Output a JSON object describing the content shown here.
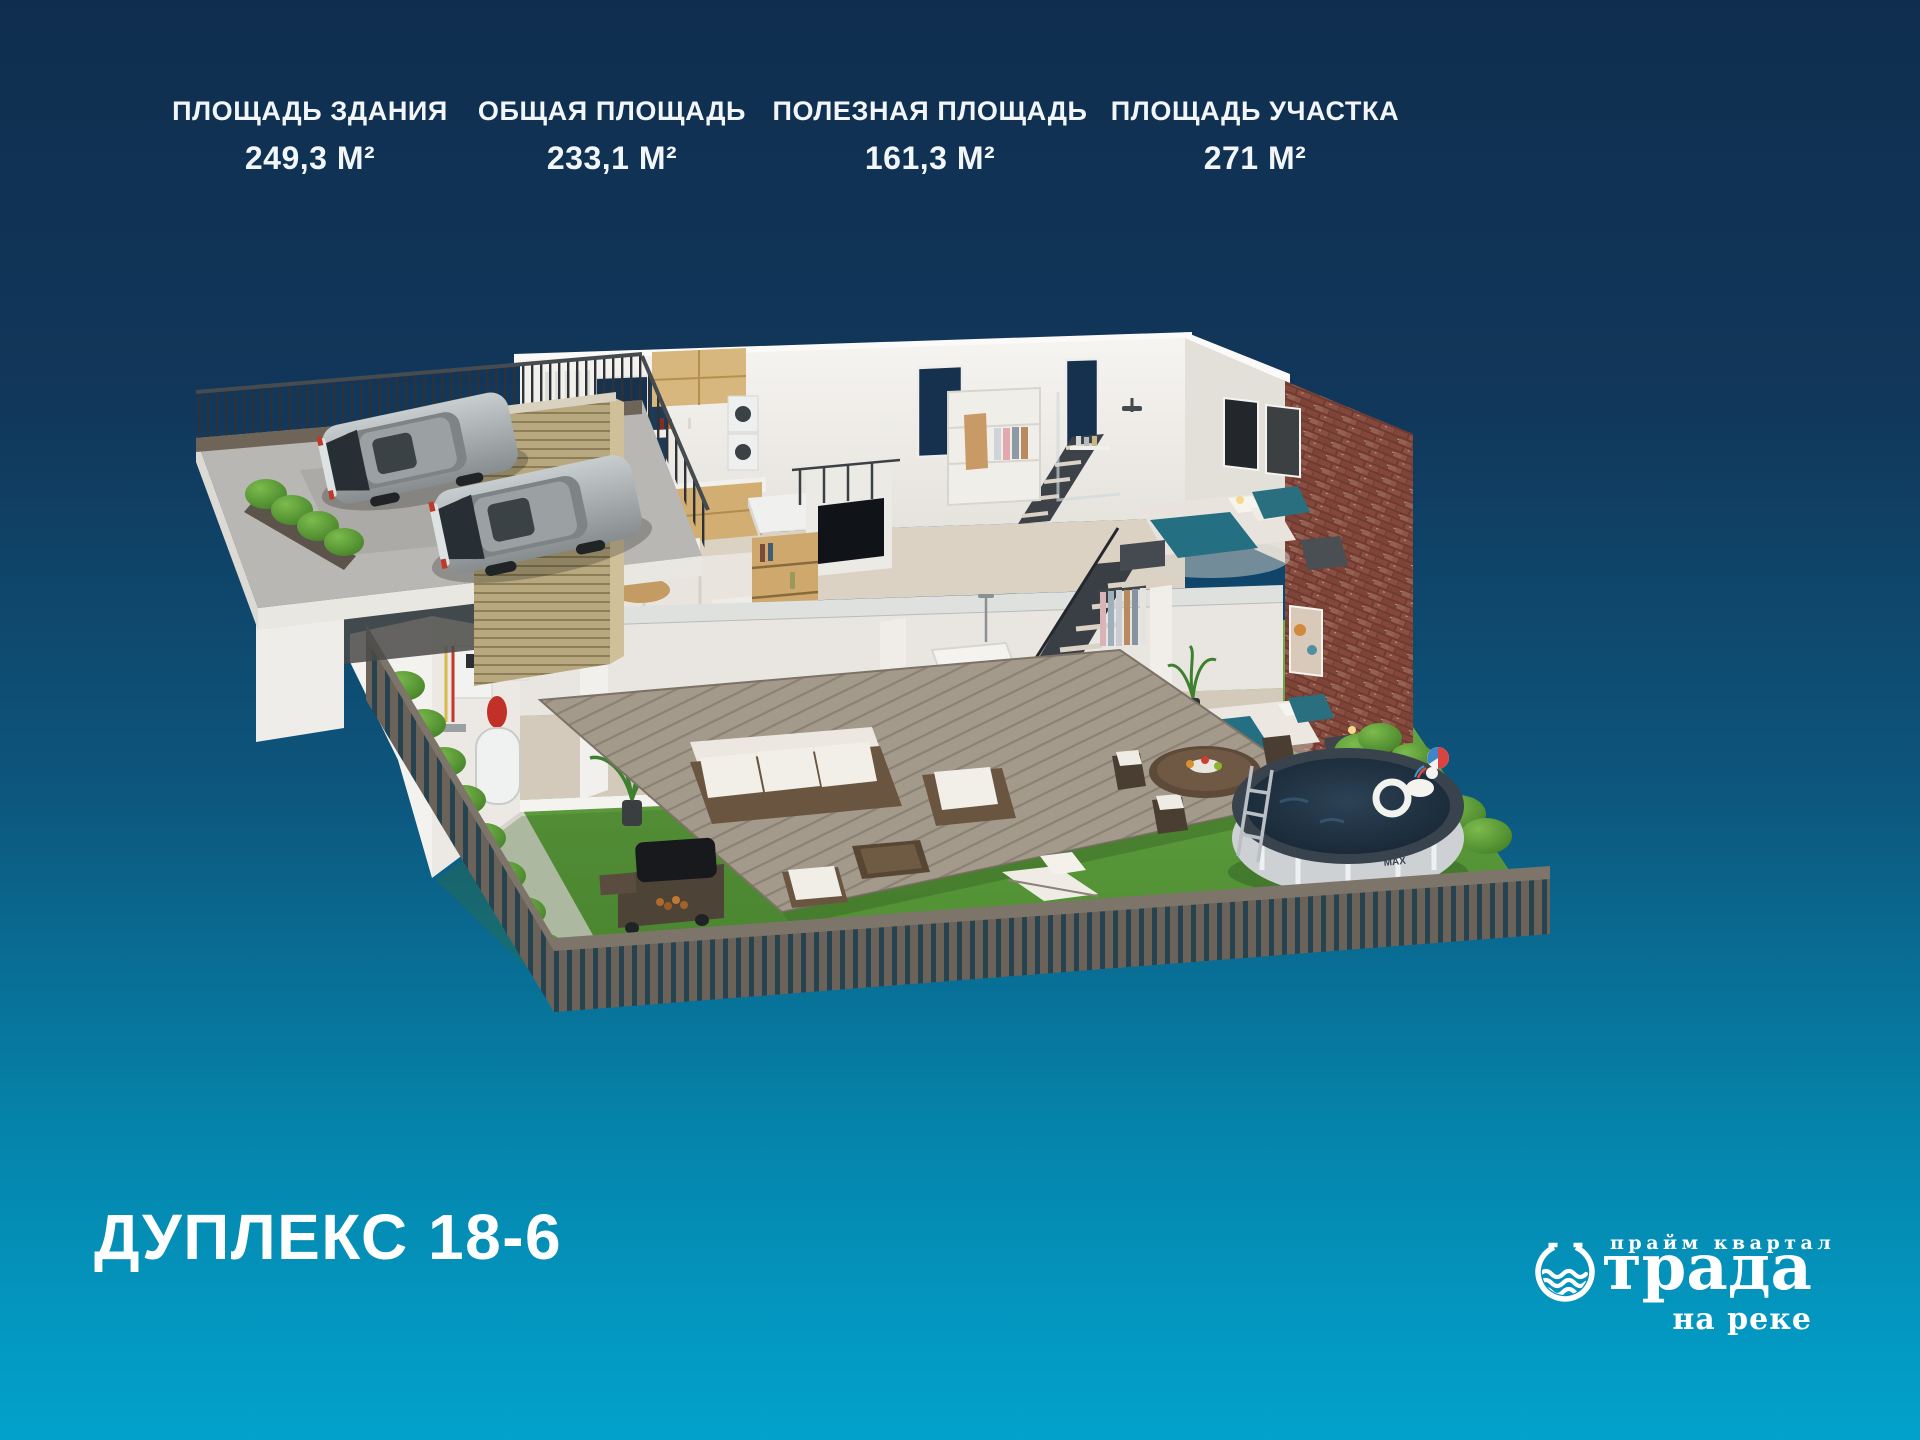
{
  "background": {
    "top": "#0f2e4f",
    "bottom": "#02a2cc"
  },
  "stats": {
    "items": [
      {
        "label": "ПЛОЩАДЬ ЗДАНИЯ",
        "value": "249,3 М²"
      },
      {
        "label": "ОБЩАЯ ПЛОЩАДЬ",
        "value": "233,1 М²"
      },
      {
        "label": "ПОЛЕЗНАЯ ПЛОЩАДЬ",
        "value": "161,3 М²"
      },
      {
        "label": "ПЛОЩАДЬ УЧАСТКА",
        "value": "271 М²"
      }
    ]
  },
  "title": "ДУПЛЕКС 18-6",
  "logo": {
    "tagline": "прайм квартал",
    "brand": "Отрада",
    "brand_suffix": "трада",
    "subtitle": "на реке"
  },
  "illustration": {
    "description": "3D cutaway render of a two-storey duplex with rooftop parking, cutaway interiors, garden terrace and round pool",
    "pool_brand": "Bestway",
    "pool_model": "MAX",
    "accent_colors": {
      "bed_teal": "#256f83",
      "brick": "#7a4237",
      "grass": "#5f9c3e",
      "glass": "#16314e"
    }
  }
}
